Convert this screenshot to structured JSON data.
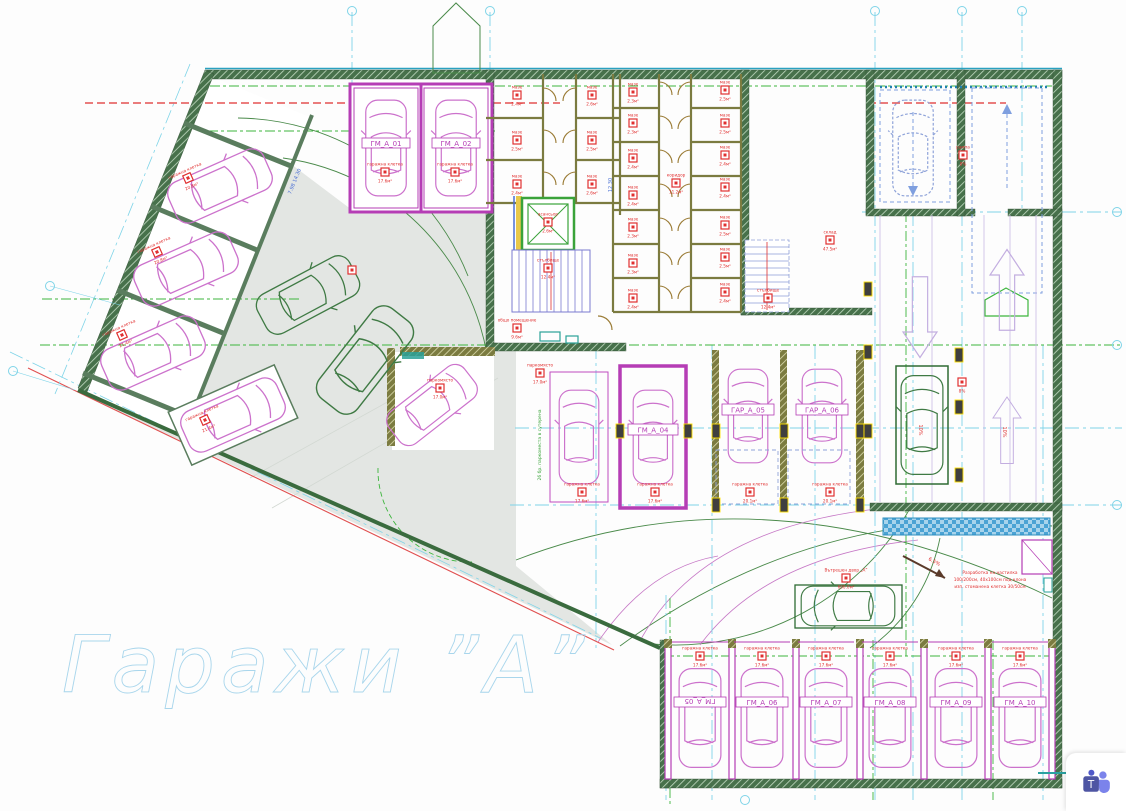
{
  "title": "Гаражи ”А”",
  "labels": {
    "top_garages": [
      "ГМ_А_01",
      "ГМ_А_02"
    ],
    "mid_garages": [
      "ГМ_А_04",
      "ГАР_А_05",
      "ГАР_А_06"
    ],
    "bottom_garages": [
      "ГМ_А_05",
      "ГМ_А_06",
      "ГМ_А_07",
      "ГМ_А_08",
      "ГМ_А_09",
      "ГМ_А_10"
    ]
  },
  "annotations": {
    "courtyard_note_lines": [
      "Разработка на настилка",
      "100/200см, 40х100см под клона",
      "изп. стоманена клетка 30/50см"
    ],
    "slope_left": "10%",
    "slope_right": "10%",
    "slope_arrow": "6.5%",
    "dim_rotated": "7.98   14.30",
    "dim_vertical": "12.30",
    "parking_note": "26 бр. паркоместа в сутерена"
  },
  "icons": {
    "teams_icon": "microsoft-teams-share"
  },
  "markers": [
    {
      "x": 188,
      "y": 178,
      "t": "гаражна клетка",
      "b": "20.8м²",
      "r": -24
    },
    {
      "x": 157,
      "y": 252,
      "t": "гаражна клетка",
      "b": "20.8м²",
      "r": -24
    },
    {
      "x": 122,
      "y": 335,
      "t": "гаражна клетка",
      "b": "21.4м²",
      "r": -24
    },
    {
      "x": 205,
      "y": 420,
      "t": "гаражна клетка",
      "b": "21.4м²",
      "r": -24
    },
    {
      "x": 385,
      "y": 172,
      "t": "гаражна клетка",
      "b": "17.6м²",
      "r": 0
    },
    {
      "x": 455,
      "y": 172,
      "t": "гаражна клетка",
      "b": "17.6м²",
      "r": 0
    },
    {
      "x": 352,
      "y": 270,
      "t": "",
      "b": "",
      "r": 0
    },
    {
      "x": 517,
      "y": 95,
      "t": "мазе",
      "b": "2.4м²",
      "r": 0
    },
    {
      "x": 517,
      "y": 140,
      "t": "мазе",
      "b": "2.5м²",
      "r": 0
    },
    {
      "x": 517,
      "y": 184,
      "t": "мазе",
      "b": "2.4м²",
      "r": 0
    },
    {
      "x": 592,
      "y": 95,
      "t": "мазе",
      "b": "2.6м²",
      "r": 0
    },
    {
      "x": 592,
      "y": 140,
      "t": "мазе",
      "b": "2.5м²",
      "r": 0
    },
    {
      "x": 592,
      "y": 184,
      "t": "мазе",
      "b": "2.6м²",
      "r": 0
    },
    {
      "x": 548,
      "y": 222,
      "t": "асансьор",
      "b": "2.6м²",
      "r": 0
    },
    {
      "x": 548,
      "y": 268,
      "t": "стълбище",
      "b": "12.4м²",
      "r": 0
    },
    {
      "x": 517,
      "y": 328,
      "t": "общо помещение",
      "b": "9.6м²",
      "r": 0
    },
    {
      "x": 540,
      "y": 373,
      "t": "паркомясто",
      "b": "17.0м²",
      "r": 0
    },
    {
      "x": 440,
      "y": 388,
      "t": "паркомясто",
      "b": "17.0м²",
      "r": 0
    },
    {
      "x": 633,
      "y": 92,
      "t": "мазе",
      "b": "2.3м²",
      "r": 0
    },
    {
      "x": 633,
      "y": 123,
      "t": "мазе",
      "b": "2.3м²",
      "r": 0
    },
    {
      "x": 633,
      "y": 158,
      "t": "мазе",
      "b": "2.4м²",
      "r": 0
    },
    {
      "x": 633,
      "y": 195,
      "t": "мазе",
      "b": "2.4м²",
      "r": 0
    },
    {
      "x": 633,
      "y": 227,
      "t": "мазе",
      "b": "2.3м²",
      "r": 0
    },
    {
      "x": 633,
      "y": 263,
      "t": "мазе",
      "b": "2.3м²",
      "r": 0
    },
    {
      "x": 633,
      "y": 298,
      "t": "мазе",
      "b": "2.4м²",
      "r": 0
    },
    {
      "x": 725,
      "y": 90,
      "t": "мазе",
      "b": "2.5м²",
      "r": 0
    },
    {
      "x": 725,
      "y": 123,
      "t": "мазе",
      "b": "2.5м²",
      "r": 0
    },
    {
      "x": 725,
      "y": 155,
      "t": "мазе",
      "b": "2.4м²",
      "r": 0
    },
    {
      "x": 725,
      "y": 187,
      "t": "мазе",
      "b": "2.4м²",
      "r": 0
    },
    {
      "x": 725,
      "y": 225,
      "t": "мазе",
      "b": "2.5м²",
      "r": 0
    },
    {
      "x": 725,
      "y": 257,
      "t": "мазе",
      "b": "2.5м²",
      "r": 0
    },
    {
      "x": 725,
      "y": 292,
      "t": "мазе",
      "b": "2.4м²",
      "r": 0
    },
    {
      "x": 676,
      "y": 183,
      "t": "коридор",
      "b": "11.2м²",
      "r": 0
    },
    {
      "x": 768,
      "y": 298,
      "t": "стълбище",
      "b": "12.4м²",
      "r": 0
    },
    {
      "x": 830,
      "y": 240,
      "t": "склад",
      "b": "47.5м²",
      "r": 0
    },
    {
      "x": 582,
      "y": 492,
      "t": "гаражна клетка",
      "b": "17.6м²",
      "r": 0
    },
    {
      "x": 655,
      "y": 492,
      "t": "гаражна клетка",
      "b": "17.6м²",
      "r": 0
    },
    {
      "x": 750,
      "y": 492,
      "t": "гаражна клетка",
      "b": "20.1м²",
      "r": 0
    },
    {
      "x": 830,
      "y": 492,
      "t": "гаражна клетка",
      "b": "20.1м²",
      "r": 0
    },
    {
      "x": 963,
      "y": 155,
      "t": "рампа",
      "b": "8%",
      "r": 0
    },
    {
      "x": 962,
      "y": 382,
      "t": "",
      "b": "8%",
      "r": 0
    },
    {
      "x": 846,
      "y": 578,
      "t": "Вътрешен двор „А”",
      "b": "600.0м²",
      "r": 0
    },
    {
      "x": 700,
      "y": 656,
      "t": "гаражна клетка",
      "b": "17.6м²",
      "r": 0
    },
    {
      "x": 762,
      "y": 656,
      "t": "гаражна клетка",
      "b": "17.6м²",
      "r": 0
    },
    {
      "x": 826,
      "y": 656,
      "t": "гаражна клетка",
      "b": "17.6м²",
      "r": 0
    },
    {
      "x": 890,
      "y": 656,
      "t": "гаражна клетка",
      "b": "17.6м²",
      "r": 0
    },
    {
      "x": 956,
      "y": 656,
      "t": "гаражна клетка",
      "b": "17.6м²",
      "r": 0
    },
    {
      "x": 1020,
      "y": 656,
      "t": "гаражна клетка",
      "b": "17.6м²",
      "r": 0
    }
  ]
}
